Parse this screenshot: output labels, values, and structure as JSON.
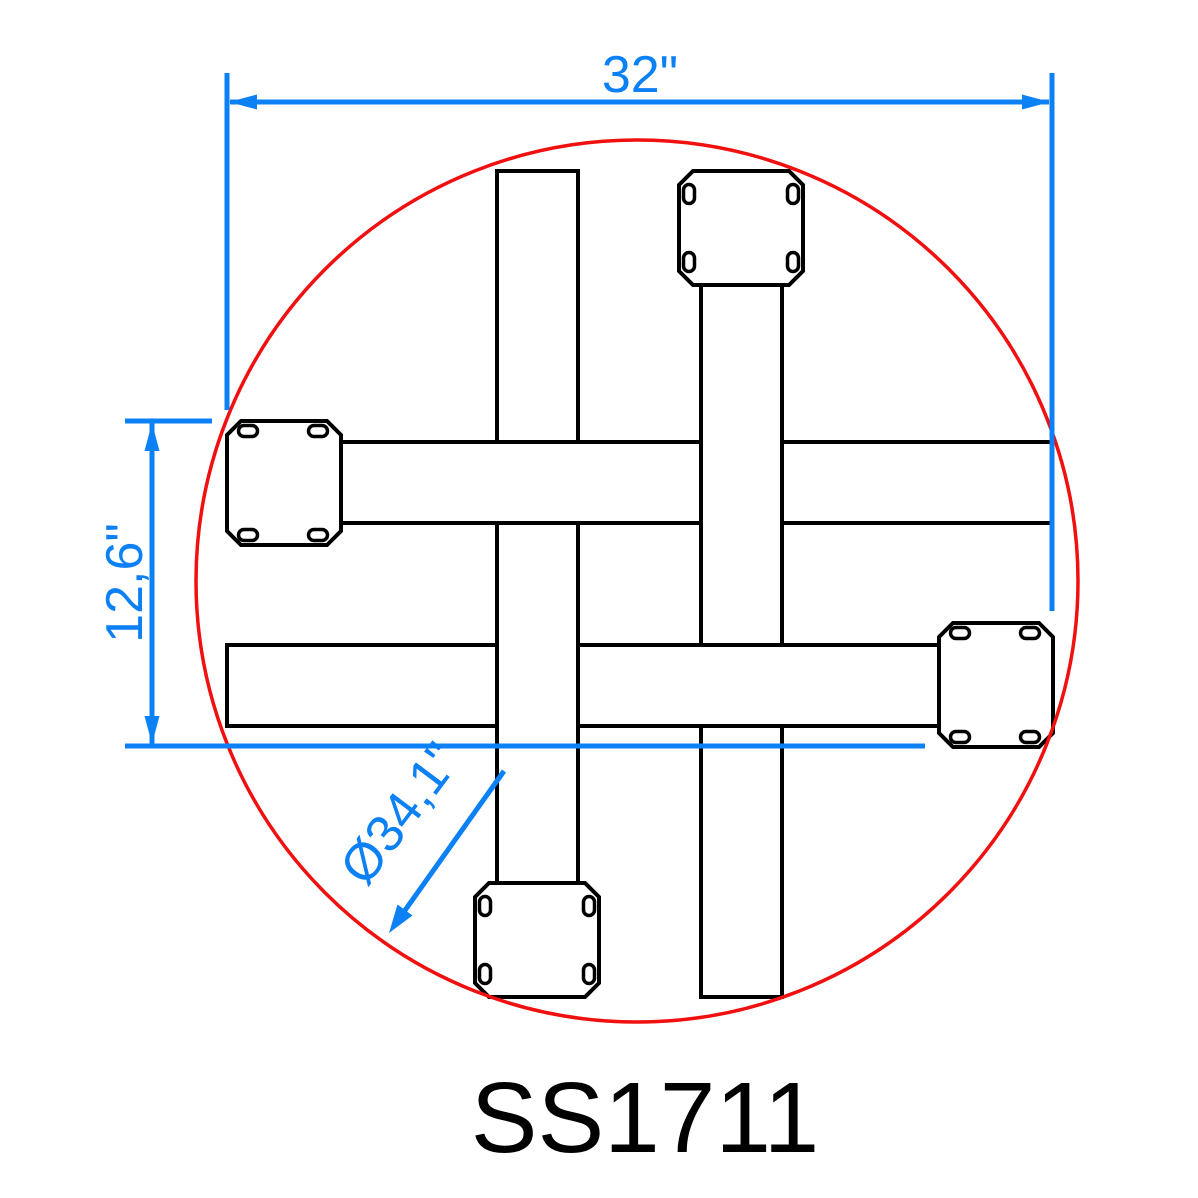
{
  "drawing": {
    "part_number": "SS1711",
    "dimensions": {
      "width_label": "32\"",
      "height_label": "12,6\"",
      "diameter_label": "Ø34,1\""
    },
    "colors": {
      "dimension_blue": "#0C80F5",
      "tabletop_red": "#F01010",
      "outline_black": "#000000"
    }
  }
}
